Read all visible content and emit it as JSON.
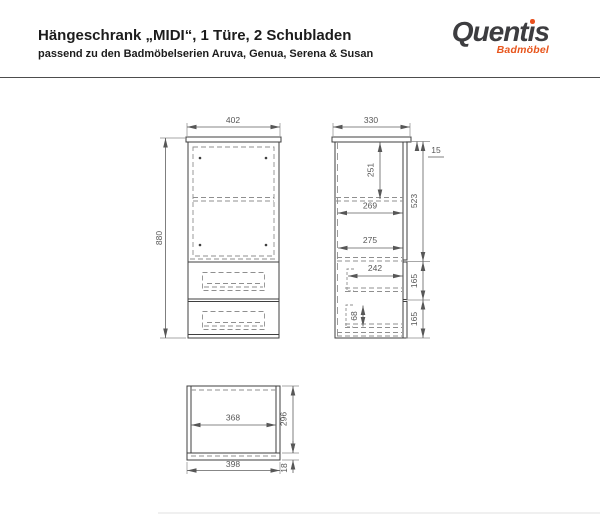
{
  "header": {
    "title": "Hängeschrank „MIDI“, 1 Türe, 2 Schubladen",
    "subtitle": "passend zu den Badmöbelserien Aruva, Genua, Serena & Susan"
  },
  "logo": {
    "part1": "Quent",
    "dotless_i": "ı",
    "part2": "s",
    "tagline": "Badmöbel",
    "text_color": "#3d3d40",
    "accent_color": "#e8501e"
  },
  "drawing": {
    "line_color": "#3f3f3f",
    "dashed_color": "#8f8f8f",
    "dim_color": "#575757",
    "front_view": {
      "width": "402",
      "height": "880"
    },
    "side_view": {
      "depth": "330",
      "top_offset": "15",
      "upper_inner_height": "251",
      "shelf_depth": "269",
      "door_height": "523",
      "drawer1_inner_depth": "275",
      "drawer2_inner_depth": "242",
      "drawer1_front_height": "165",
      "drawer2_front_height": "165",
      "drawer_inner_height": "68"
    },
    "top_view": {
      "inner_width": "368",
      "depth": "296",
      "outer_width": "398",
      "back_panel_offset": "18"
    }
  }
}
